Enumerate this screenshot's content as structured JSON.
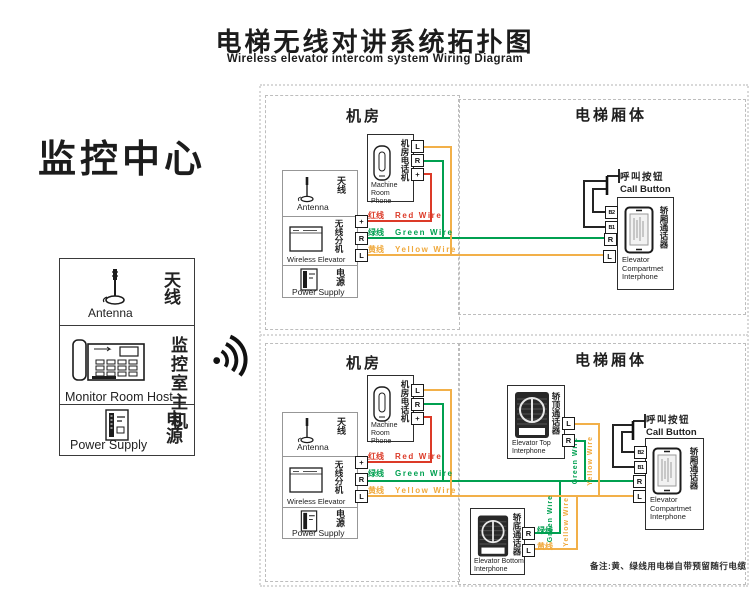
{
  "page": {
    "title_zh": "电梯无线对讲系统拓扑图",
    "title_en": "Wireless elevator intercom system Wiring Diagram",
    "note": "备注:黄、绿线用电梯自带预留随行电缆"
  },
  "monitor_center": {
    "heading": "监控中心",
    "antenna_zh": "天线",
    "antenna_en": "Antenna",
    "host_zh": "监控室主机",
    "host_en": "Monitor Room Host",
    "power_zh": "电源",
    "power_en": "Power Supply"
  },
  "sections": {
    "machine_room": "机房",
    "elevator_car": "电梯厢体"
  },
  "devices": {
    "phone_zh": "机房电话机",
    "phone_en": "Machine Room Phone",
    "antenna_zh": "天线",
    "antenna_en": "Antenna",
    "wireless_zh": "无线分机",
    "wireless_en": "Wireless Elevator",
    "power_zh": "电源",
    "power_en": "Power Supply",
    "call_zh": "呼叫按钮",
    "call_en": "Call Button",
    "compartment_zh": "轿厢通话器",
    "compartment_en": "Elevator Compartmet Interphone",
    "top_zh": "轿顶通话器",
    "top_en": "Elevator Top Interphone",
    "bottom_zh": "轿底通话器",
    "bottom_en": "Elevator Bottom Interphone"
  },
  "wires": {
    "red_zh": "红线",
    "red_en": "Red Wire",
    "red_color": "#dc3a28",
    "green_zh": "绿线",
    "green_en": "Green Wire",
    "green_color": "#00a050",
    "yellow_zh": "黄线",
    "yellow_en": "Yellow Wire",
    "yellow_color": "#f2b049"
  },
  "terminals": {
    "l": "L",
    "r": "R",
    "plus": "+",
    "b1": "B1",
    "b2": "B2"
  }
}
